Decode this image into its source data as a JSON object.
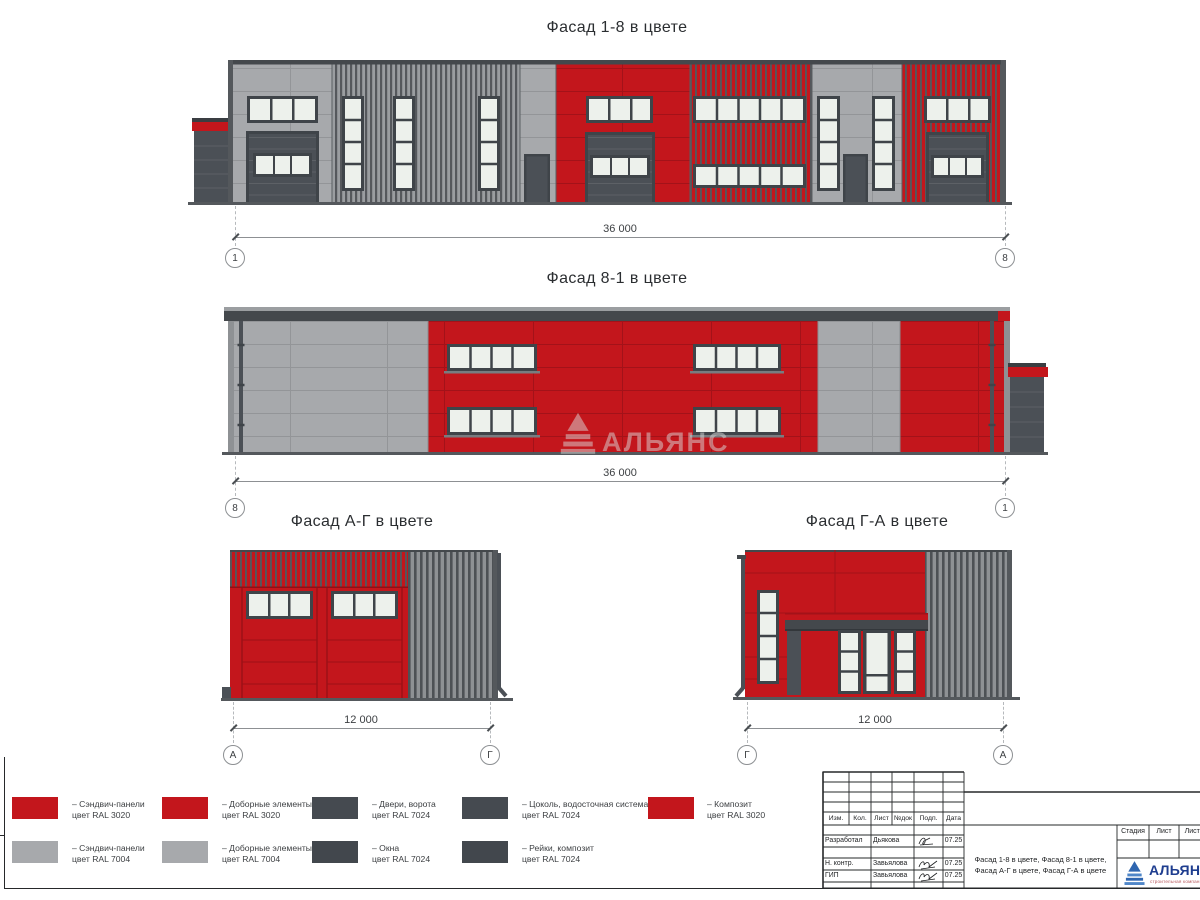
{
  "sheet": {
    "watermark_text": "АЛЬЯНС"
  },
  "facades": {
    "f18": {
      "title": "Фасад 1-8 в цвете",
      "dimension": "36 000",
      "axis_left": "1",
      "axis_right": "8"
    },
    "f81": {
      "title": "Фасад 8-1 в цвете",
      "dimension": "36 000",
      "axis_left": "8",
      "axis_right": "1"
    },
    "fag": {
      "title": "Фасад А-Г в цвете",
      "dimension": "12 000",
      "axis_left": "А",
      "axis_right": "Г"
    },
    "fga": {
      "title": "Фасад Г-А в цвете",
      "dimension": "12 000",
      "axis_left": "Г",
      "axis_right": "А"
    }
  },
  "colors": {
    "ral_3020_red": "#c3161c",
    "ral_7004_gray": "#a7a9ac",
    "ral_7024_dark": "#454a50",
    "window_glass": "#edf1ec",
    "logo_blue": "#2f66b0"
  },
  "legend": {
    "items": [
      {
        "label": "– Сэндвич-панели",
        "ral": "цвет RAL 3020",
        "swatch_style": "background:#c3161c"
      },
      {
        "label": "– Доборные элементы",
        "ral": "цвет RAL 3020",
        "swatch_style": "background:#c3161c"
      },
      {
        "label": "– Двери, ворота",
        "ral": "цвет RAL 7024",
        "swatch_style": "background:#454a50"
      },
      {
        "label": "– Цоколь, водосточная система",
        "ral": "цвет RAL 7024",
        "swatch_style": "background:#454a50"
      },
      {
        "label": "– Композит",
        "ral": "цвет RAL 3020",
        "swatch_style": "background:#c3161c"
      },
      {
        "label": "– Сэндвич-панели",
        "ral": "цвет RAL 7004",
        "swatch_style": "background:#a7a9ac"
      },
      {
        "label": "– Доборные элементы",
        "ral": "цвет RAL 7004",
        "swatch_style": "background:#a7a9ac"
      },
      {
        "label": "– Окна",
        "ral": "цвет RAL 7024",
        "swatch_style": "background:#42474d"
      },
      {
        "label": "– Рейки, композит",
        "ral": "цвет RAL 7024",
        "swatch_style": "background:#42474d"
      }
    ]
  },
  "title_block": {
    "header_cols": [
      "Изм.",
      "Кол.",
      "Лист",
      "№док",
      "Подп.",
      "Дата"
    ],
    "rows": [
      {
        "role": "Разработал",
        "name": "Дьякова",
        "date": "07.25"
      },
      {
        "role": "Н. контр.",
        "name": "Завьялова",
        "date": "07.25"
      },
      {
        "role": "ГИП",
        "name": "Завьялова",
        "date": "07.25"
      }
    ],
    "doc_title": "Фасад 1-8 в цвете, Фасад 8-1 в цвете, Фасад А-Г в цвете, Фасад Г-А в цвете",
    "stage_cols": [
      "Стадия",
      "Лист",
      "Листов"
    ],
    "logo": {
      "name": "АЛЬЯНС",
      "tagline": "строительная компания"
    }
  }
}
